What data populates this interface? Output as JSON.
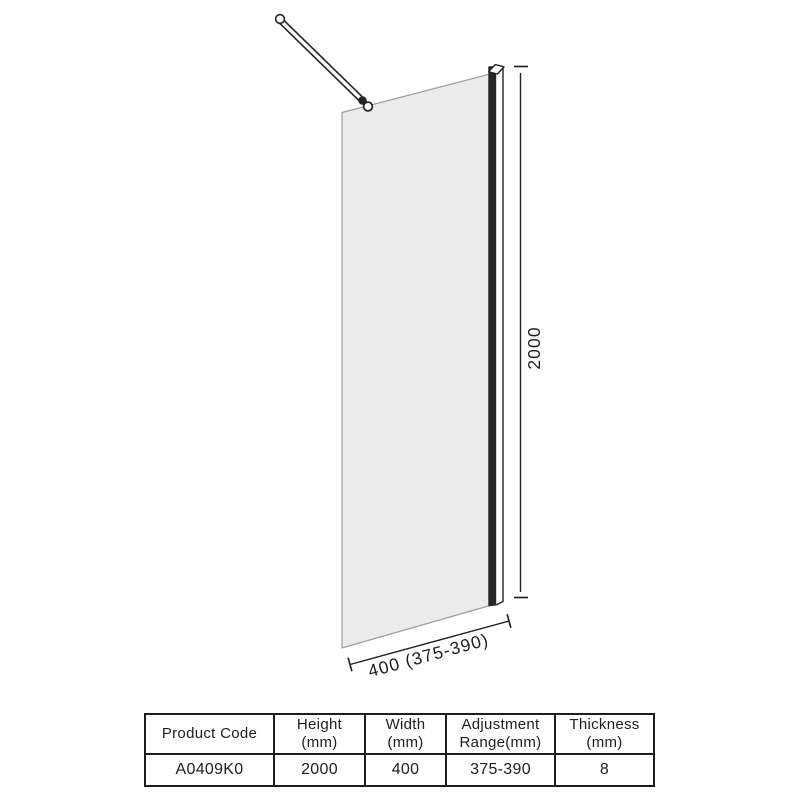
{
  "dimensions": {
    "height_label": "2000",
    "width_label": "400 (375-390)"
  },
  "spec_table": {
    "headers": [
      {
        "line1": "Product Code",
        "line2": ""
      },
      {
        "line1": "Height",
        "line2": "(mm)"
      },
      {
        "line1": "Width",
        "line2": "(mm)"
      },
      {
        "line1": "Adjustment",
        "line2": "Range(mm)"
      },
      {
        "line1": "Thickness",
        "line2": "(mm)"
      }
    ],
    "row": {
      "product_code": "A0409K0",
      "height": "2000",
      "width": "400",
      "adjustment_range": "375-390",
      "thickness": "8"
    }
  },
  "colors": {
    "ink": "#1d1d1d",
    "glass_fill": "#ebebeb",
    "glass_stroke": "#9c9c9c"
  }
}
